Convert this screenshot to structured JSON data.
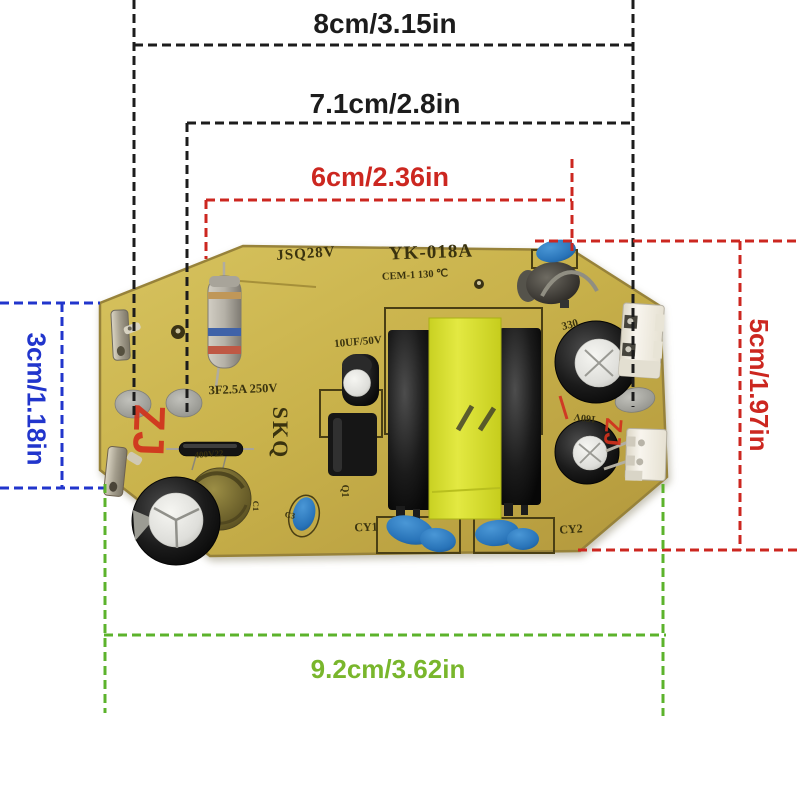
{
  "figure": {
    "type": "product-dimension-photo",
    "subject": "humidifier power supply PCB",
    "background_color": "#ffffff"
  },
  "dimensions": {
    "width_top": {
      "label": "8cm/3.15in",
      "color": "#1c1c1c"
    },
    "width_middle": {
      "label": "7.1cm/2.8in",
      "color": "#1c1c1c"
    },
    "width_inner": {
      "label": "6cm/2.36in",
      "color": "#cc2720"
    },
    "height_left": {
      "label": "3cm/1.18in",
      "color": "#2135cc"
    },
    "height_right": {
      "label": "5cm/1.97in",
      "color": "#d02a1e"
    },
    "width_bottom": {
      "label": "9.2cm/3.62in",
      "color": "#79b62c"
    }
  },
  "board": {
    "base_color": "#c8b24a",
    "silkscreen_color": "#3a330f",
    "labels": {
      "model_left": "JSQ28V",
      "model_main": "YK-018A",
      "material_rating": "CEM-1 130 ℃",
      "fuse_rating": "3F2.5A 250V",
      "cap_rating": "10UF/50V",
      "brand": "SKQ",
      "cy1": "CY1",
      "cy2": "CY2",
      "q1": "Q1",
      "c330": "330",
      "c160": "160V",
      "c400": "400V22",
      "c1": "C1",
      "c3": "C3"
    },
    "watermark": {
      "text": "ZJ",
      "color": "#d1311c"
    },
    "component_colors": {
      "transformer_tape": "#d9e02f",
      "electrolytic_sleeve": "#1d1d1d",
      "disc_capacitor_blue": "#2b7cc3",
      "connector_white": "#f2efe6",
      "solder_pad_gray": "#aaaaa4",
      "fuse_body_gray": "#b5b1a7"
    }
  }
}
